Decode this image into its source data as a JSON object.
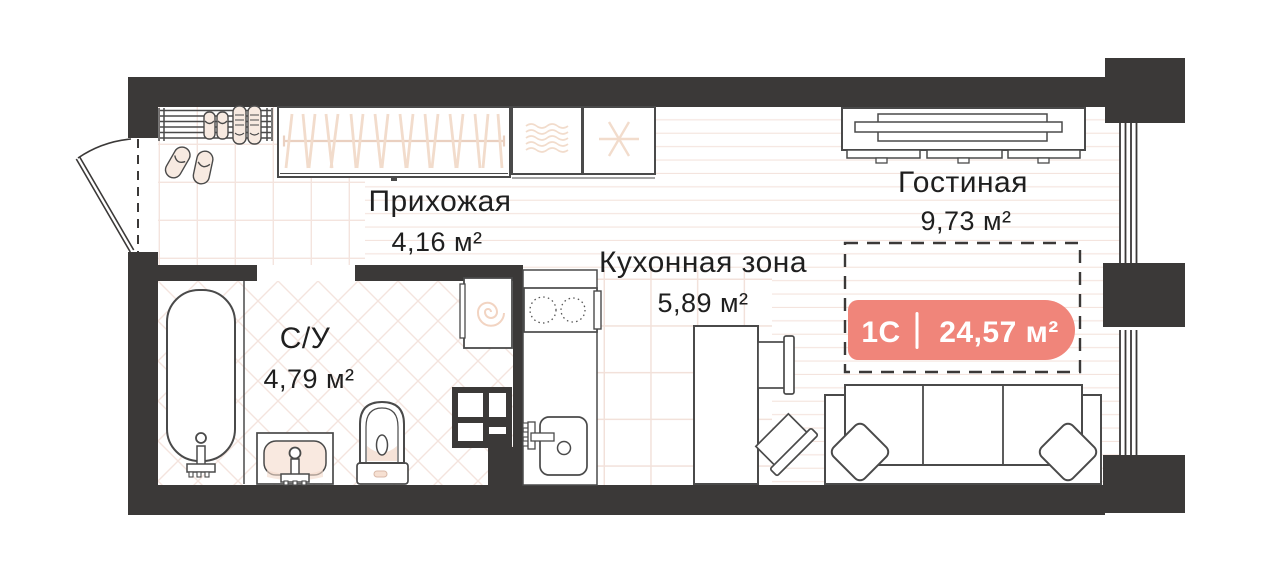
{
  "floor_plan": {
    "rooms": [
      {
        "key": "hallway",
        "name": "Прихожая",
        "area": "4,16 м²"
      },
      {
        "key": "kitchen",
        "name": "Кухонная зона",
        "area": "5,89 м²"
      },
      {
        "key": "living",
        "name": "Гостиная",
        "area": "9,73 м²"
      },
      {
        "key": "bathroom",
        "name": "С/У",
        "area": "4,79 м²"
      }
    ],
    "unit_badge": {
      "unit_type": "1С",
      "divider": "|",
      "area": "24,57 м²",
      "background": "#F0857A",
      "text_color": "#FFFFFF"
    },
    "icons": {
      "wardrobe": "hangers-icon",
      "fridge_cabinet": "snowflake-icon",
      "dryer_cabinet": "waves-icon",
      "washing_machine": "spiral-icon"
    },
    "colors": {
      "wall": "#3B3938",
      "furniture_outline": "#4A4A4A",
      "decor_accent": "#F2D8C8",
      "floor_pattern": "#F4E4DE",
      "label_text": "#1F1F1F"
    }
  }
}
